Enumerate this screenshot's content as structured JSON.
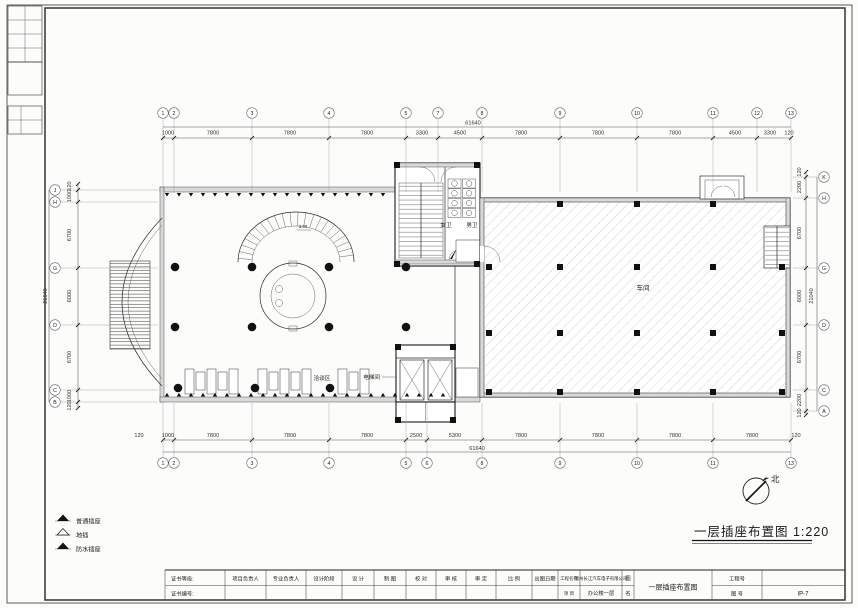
{
  "sheet": {
    "drawing_title": "一层插座布置图 1:220",
    "north_label": "北"
  },
  "legend": {
    "items": [
      {
        "label": "普通插座"
      },
      {
        "label": "地插"
      },
      {
        "label": "防水插座"
      }
    ]
  },
  "plan_labels": {
    "womens_wc": "女卫",
    "mens_wc": "男卫",
    "workshop": "车间",
    "negotiation_area": "洽谈区",
    "elevator": "电梯间",
    "stair_elevation": "3.30"
  },
  "grid": {
    "top": {
      "overall": "61640",
      "bubbles": [
        "1",
        "2",
        "3",
        "4",
        "5",
        "7",
        "8",
        "9",
        "10",
        "11",
        "12",
        "13"
      ],
      "dims": [
        "1000",
        "7800",
        "7800",
        "7800",
        "3300",
        "4500",
        "7800",
        "7800",
        "7800",
        "4500",
        "3300",
        "120"
      ]
    },
    "bottom": {
      "overall": "61640",
      "bubbles": [
        "1",
        "2",
        "3",
        "4",
        "5",
        "6",
        "8",
        "9",
        "10",
        "11",
        "13"
      ],
      "dims": [
        "120",
        "1000",
        "7800",
        "7800",
        "7800",
        "2500",
        "5300",
        "7800",
        "7800",
        "7800",
        "7800",
        "120"
      ]
    },
    "left": {
      "overall": "21640",
      "bubbles": [
        "J",
        "H",
        "G",
        "D",
        "C",
        "B"
      ],
      "dims": [
        "120",
        "1000",
        "6700",
        "6000",
        "6700",
        "1000",
        "120"
      ]
    },
    "right": {
      "overall": "21040",
      "bubbles": [
        "K",
        "H",
        "G",
        "D",
        "C",
        "A"
      ],
      "dims": [
        "120",
        "2200",
        "6700",
        "6000",
        "6700",
        "2200",
        "120"
      ]
    }
  },
  "title_block": {
    "cert_grade_label": "证书等级:",
    "cert_no_label": "证书编号:",
    "sign_columns": [
      "项目负责人",
      "专业负责人",
      "设计阶段",
      "设 计",
      "制 图",
      "校 对",
      "审 核",
      "审 定",
      "比 例",
      "出图日期"
    ],
    "project_label_top": "工程名称",
    "project_label_bottom": "项 目",
    "project_name_line1": "温州长江汽车电子有限公司",
    "project_name_line2": "办公楼一层",
    "drawing_label_top": "图",
    "drawing_label_bottom": "名",
    "drawing_name": "一层插座布置图",
    "job_no_label": "工程号",
    "sheet_no_label": "图 号",
    "sheet_no_value": "IP-7"
  }
}
